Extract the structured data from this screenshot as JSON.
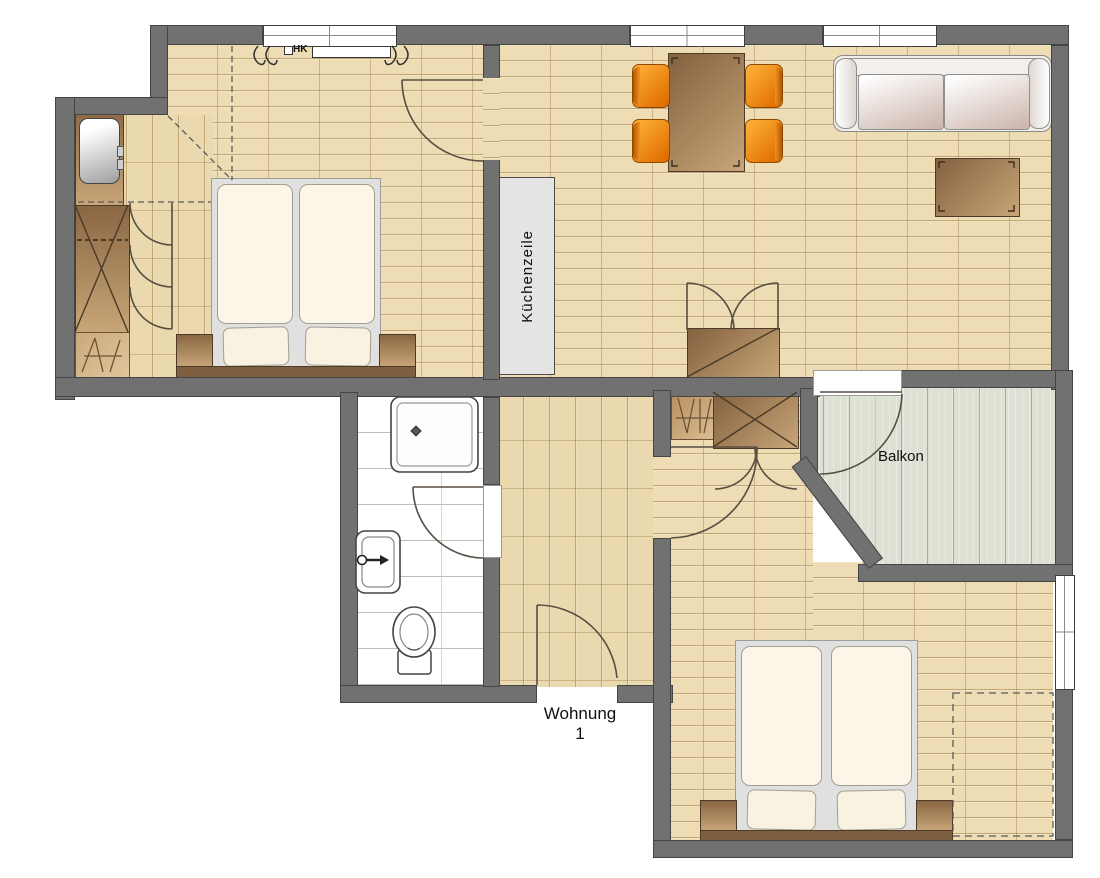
{
  "labels": {
    "apartment_line1": "Wohnung",
    "apartment_line2": "1",
    "balcony": "Balkon",
    "kitchen_unit": "Küchenzeile",
    "radiator": "HK"
  },
  "colors": {
    "wall": "#717171",
    "wood_floor": "#eddcb4",
    "hall_floor": "#ead8ae",
    "plank_joint": "#96703a",
    "bathroom_tile": "#ffffff",
    "balcony_deck": "#dce1d3",
    "chair_orange": "#f08c1e",
    "furniture_brown": "#a97e52",
    "sofa": "#f1ede9",
    "bed_linen": "#fbf6e8",
    "kitchen_counter": "#e4e4e4"
  },
  "furniture_icons": [
    "double-bed",
    "nightstand",
    "wardrobe-with-x",
    "wardrobe-door-swings",
    "entrance-cabinet-basin",
    "dining-table",
    "chair",
    "sofa",
    "coffee-table",
    "kitchen-unit",
    "radiator",
    "hall-closet-x",
    "hall-open-shelf",
    "living-room-closet",
    "double-door-swing",
    "shower-tray",
    "wash-basin",
    "toilet",
    "planned-wardrobe-dashed",
    "window",
    "door-swing"
  ]
}
